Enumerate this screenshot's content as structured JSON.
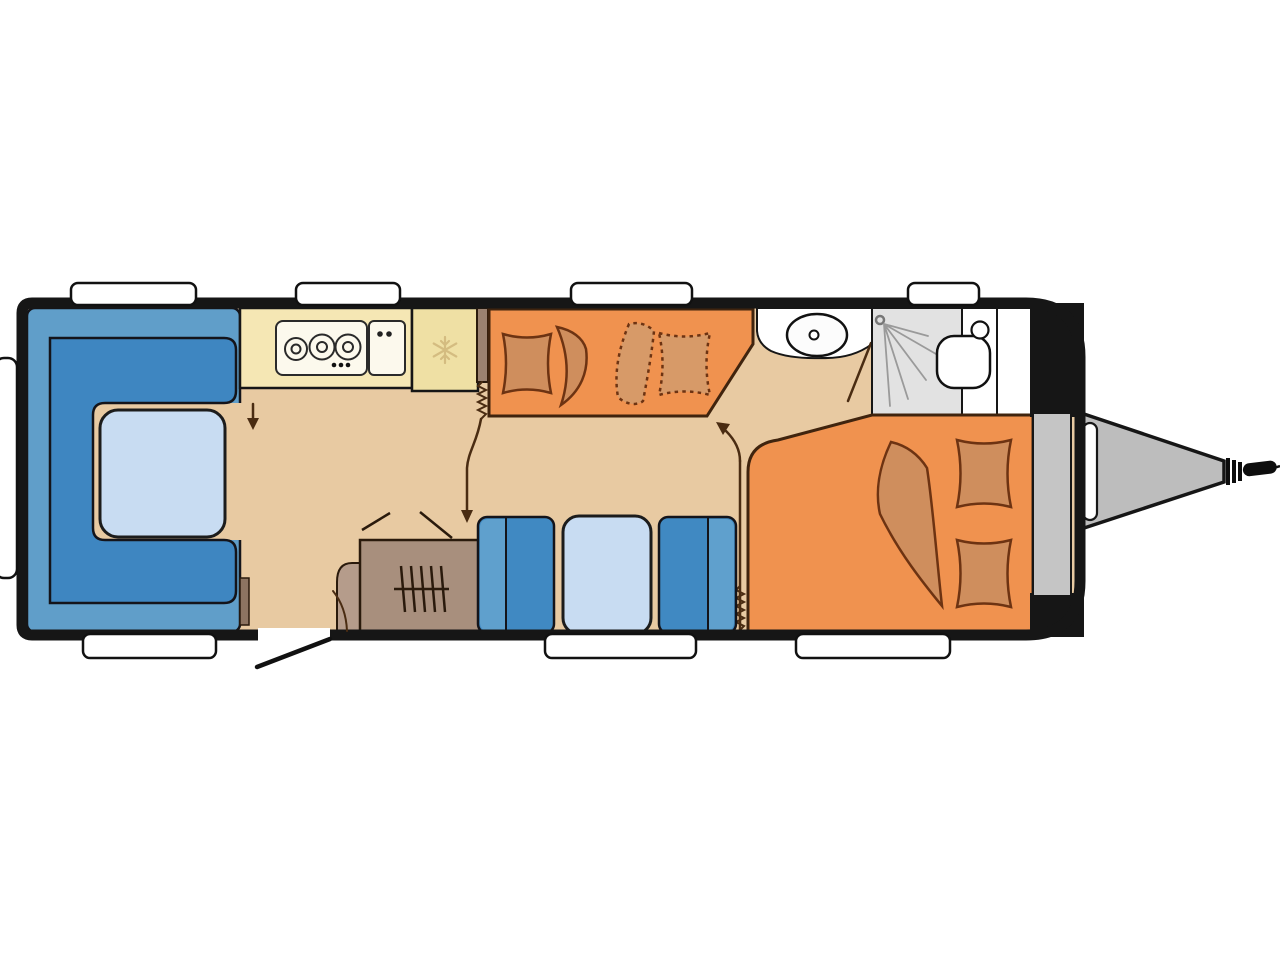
{
  "diagram": {
    "type": "caravan-floor-plan",
    "rooms": [
      {
        "id": "front-lounge",
        "desc": "U-shaped seating group with table"
      },
      {
        "id": "kitchen",
        "desc": "Kitchen block with 3-burner hob, sink and fridge"
      },
      {
        "id": "bunk-beds",
        "desc": "Transverse bunk beds (lower solid, upper dashed)"
      },
      {
        "id": "middle-dinette",
        "desc": "Two facing seats with table"
      },
      {
        "id": "wardrobe",
        "desc": "Wardrobe with hanging rail"
      },
      {
        "id": "washroom",
        "desc": "Washbasin, shower cubicle and toilet"
      },
      {
        "id": "rear-bed",
        "desc": "Double bed with pillows and blanket"
      },
      {
        "id": "front-locker",
        "desc": "Gas locker / storage strip at drawbar end"
      },
      {
        "id": "drawbar",
        "desc": "A-frame hitch with coupling"
      }
    ],
    "icons": [
      "hob-burners-icon",
      "sink-taps-icon",
      "snowflake-icon",
      "hanger-rail-icon",
      "shower-spray-icon",
      "toilet-icon",
      "washbasin-icon",
      "concertina-door-icon",
      "door-swing-icon",
      "fold-down-arrow-icon"
    ],
    "window_count": 8,
    "entry": "side door with swing line on lower wall"
  },
  "colors": {
    "background": "#ffffff",
    "wall": "#161616",
    "floor": "#e8caa2",
    "sofa_outer": "#609ec9",
    "sofa_inner": "#3e86c1",
    "table_top": "#c8dcf2",
    "seat_mid": "#4089c2",
    "seat_light": "#5fa0cd",
    "kitchen_counter": "#f5e7b4",
    "fridge": "#efe0a4",
    "appliance_panel": "#fcf9ed",
    "snowflake": "#d4bc80",
    "bed_orange": "#f0924f",
    "bedding_tan": "#cf8e5d",
    "bedding_tan_light": "#d79a68",
    "wardrobe_brown": "#a88f7d",
    "wardrobe_ext": "#b59c8b",
    "end_panel_brown": "#8d7461",
    "bathroom_white": "#ffffff",
    "shower_gray": "#e2e2e2",
    "locker_gray": "#c5c5c5",
    "hitch_gray": "#bdbdbd",
    "window_white": "#ffffff",
    "annotation": "#4a2c12"
  }
}
